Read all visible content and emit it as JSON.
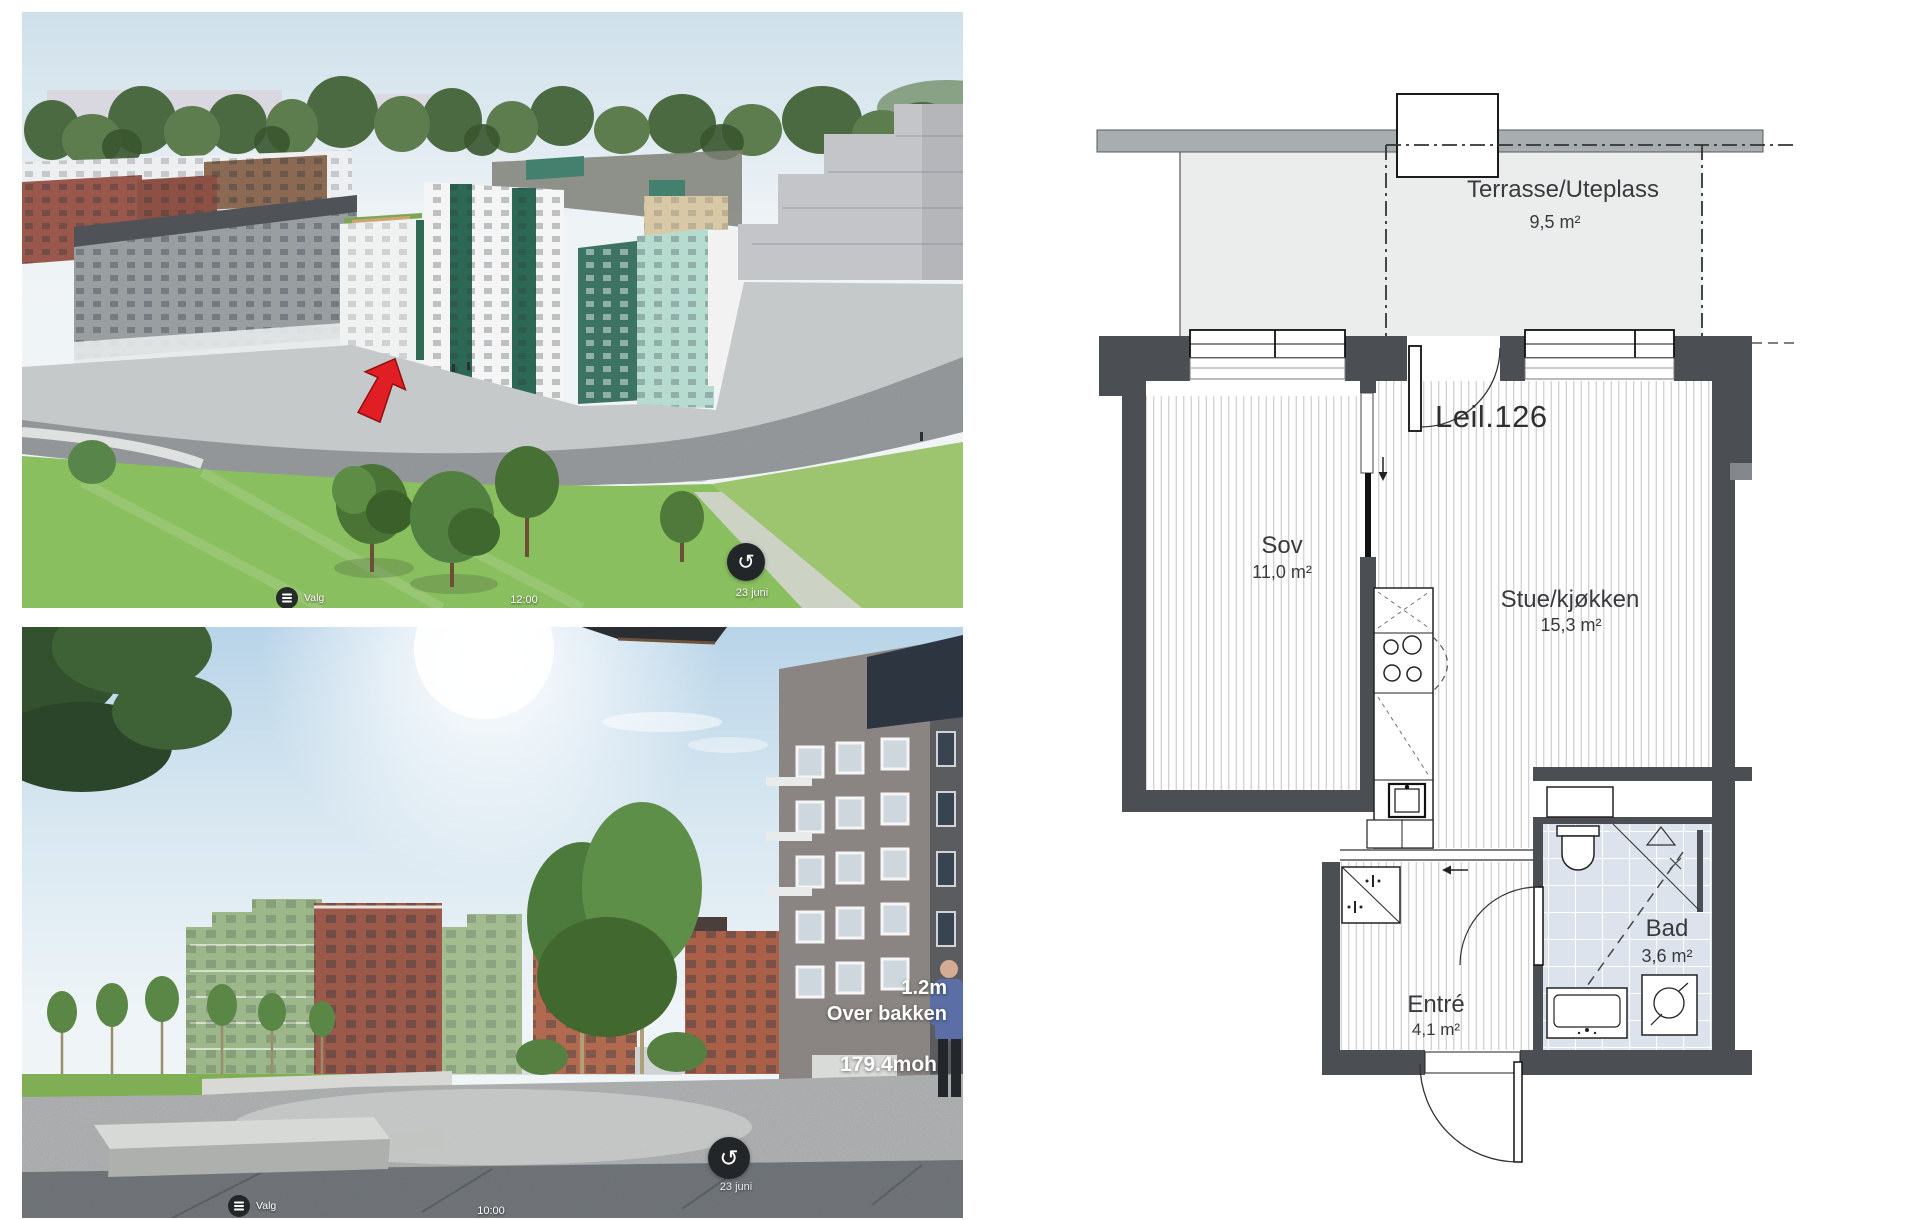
{
  "viewer_top": {
    "menu_label": "Valg",
    "time": "12:00",
    "date": "23 juni"
  },
  "viewer_bottom": {
    "menu_label": "Valg",
    "time": "10:00",
    "date": "23 juni",
    "overlay": {
      "height": "1.2m",
      "height_caption": "Over bakken",
      "elevation": "179.4moh"
    }
  },
  "floorplan": {
    "unit": "Leil.126",
    "terrace": {
      "name": "Terrasse/Uteplass",
      "area": "9,5 m²"
    },
    "bedroom": {
      "name": "Sov",
      "area": "11,0 m²"
    },
    "living": {
      "name": "Stue/kjøkken",
      "area": "15,3 m²"
    },
    "entry": {
      "name": "Entré",
      "area": "4,1 m²"
    },
    "bath": {
      "name": "Bad",
      "area": "3,6 m²"
    }
  },
  "icons": {
    "rotate": "↺",
    "menu": "list-menu"
  },
  "colors": {
    "wall": "#4b4f53",
    "terrace_fill": "#ebecec",
    "bath_tile": "#dce3ec",
    "facade_green": "#2d6854",
    "facade_mint": "#b6dccf",
    "arrow_red": "#e01e24"
  }
}
